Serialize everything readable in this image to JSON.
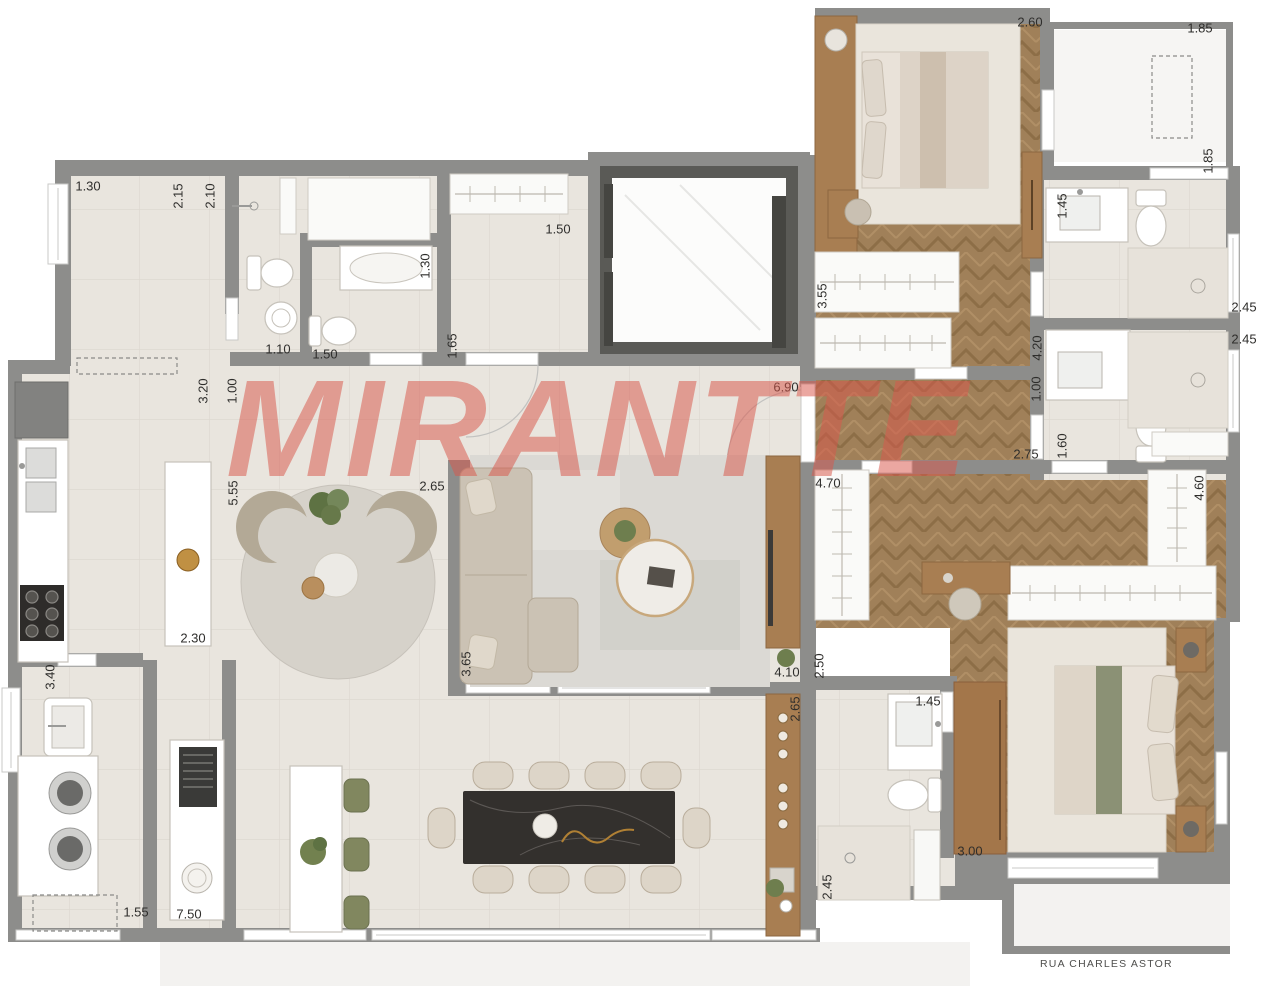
{
  "watermark": "MIRANTTE",
  "street_label": "RUA CHARLES ASTOR",
  "colors": {
    "watermark": "#d9584c",
    "walls": "#8d8d8b",
    "wood_floor": "#a08059",
    "tile_floor": "#e9e5de",
    "accent_green": "#7d8663"
  },
  "dimension_labels": [
    {
      "text": "1.30",
      "x": 88,
      "y": 186,
      "rotated": false
    },
    {
      "text": "2.15",
      "x": 178,
      "y": 196,
      "rotated": true
    },
    {
      "text": "2.10",
      "x": 210,
      "y": 196,
      "rotated": true
    },
    {
      "text": "1.30",
      "x": 425,
      "y": 266,
      "rotated": true
    },
    {
      "text": "1.50",
      "x": 558,
      "y": 229,
      "rotated": false
    },
    {
      "text": "1.10",
      "x": 278,
      "y": 349,
      "rotated": false
    },
    {
      "text": "1.50",
      "x": 325,
      "y": 354,
      "rotated": false
    },
    {
      "text": "1.65",
      "x": 452,
      "y": 346,
      "rotated": true
    },
    {
      "text": "3.20",
      "x": 203,
      "y": 391,
      "rotated": true
    },
    {
      "text": "1.00",
      "x": 232,
      "y": 391,
      "rotated": true
    },
    {
      "text": "6.90",
      "x": 786,
      "y": 387,
      "rotated": false
    },
    {
      "text": "5.55",
      "x": 233,
      "y": 493,
      "rotated": true
    },
    {
      "text": "2.65",
      "x": 432,
      "y": 486,
      "rotated": false
    },
    {
      "text": "2.30",
      "x": 193,
      "y": 638,
      "rotated": false
    },
    {
      "text": "3.40",
      "x": 50,
      "y": 677,
      "rotated": true
    },
    {
      "text": "1.55",
      "x": 136,
      "y": 912,
      "rotated": false
    },
    {
      "text": "7.50",
      "x": 189,
      "y": 914,
      "rotated": false
    },
    {
      "text": "3.65",
      "x": 466,
      "y": 664,
      "rotated": true
    },
    {
      "text": "4.10",
      "x": 787,
      "y": 672,
      "rotated": false
    },
    {
      "text": "2.50",
      "x": 819,
      "y": 666,
      "rotated": true
    },
    {
      "text": "2.65",
      "x": 795,
      "y": 709,
      "rotated": true
    },
    {
      "text": "2.45",
      "x": 827,
      "y": 887,
      "rotated": true
    },
    {
      "text": "4.70",
      "x": 828,
      "y": 483,
      "rotated": false
    },
    {
      "text": "2.75",
      "x": 1026,
      "y": 454,
      "rotated": false
    },
    {
      "text": "1.00",
      "x": 1036,
      "y": 389,
      "rotated": true
    },
    {
      "text": "4.20",
      "x": 1037,
      "y": 348,
      "rotated": true
    },
    {
      "text": "1.60",
      "x": 1062,
      "y": 446,
      "rotated": true
    },
    {
      "text": "4.60",
      "x": 1199,
      "y": 488,
      "rotated": true
    },
    {
      "text": "2.60",
      "x": 1030,
      "y": 22,
      "rotated": false
    },
    {
      "text": "1.85",
      "x": 1200,
      "y": 28,
      "rotated": false
    },
    {
      "text": "1.85",
      "x": 1208,
      "y": 161,
      "rotated": true
    },
    {
      "text": "1.45",
      "x": 1062,
      "y": 206,
      "rotated": true
    },
    {
      "text": "3.55",
      "x": 822,
      "y": 296,
      "rotated": true
    },
    {
      "text": "2.45",
      "x": 1244,
      "y": 307,
      "rotated": false
    },
    {
      "text": "2.45",
      "x": 1244,
      "y": 339,
      "rotated": false
    },
    {
      "text": "1.45",
      "x": 928,
      "y": 701,
      "rotated": false
    },
    {
      "text": "3.00",
      "x": 970,
      "y": 851,
      "rotated": false
    }
  ]
}
